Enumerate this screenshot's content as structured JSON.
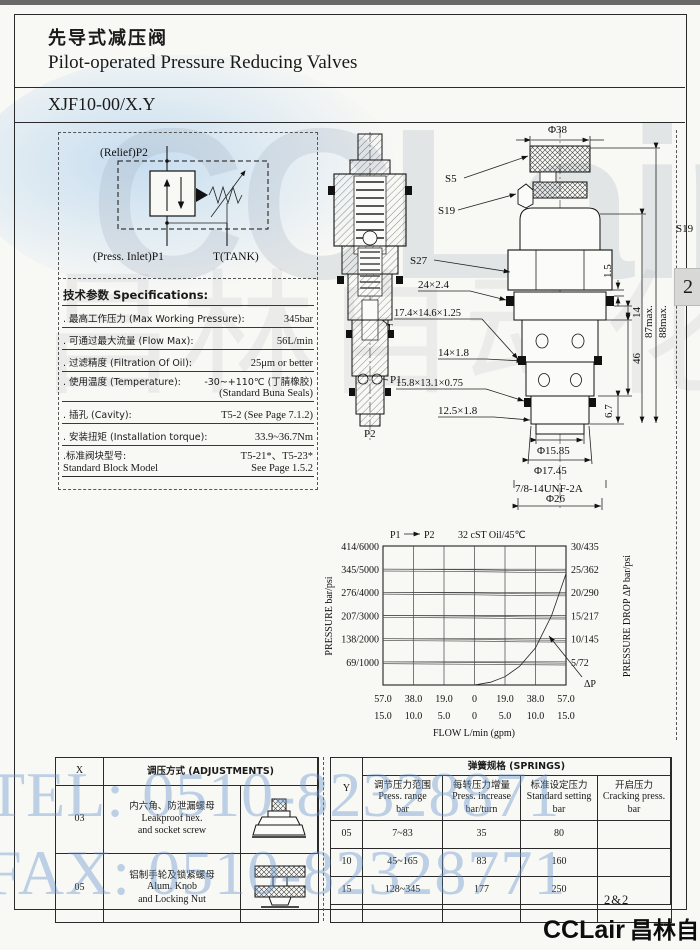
{
  "header": {
    "title_cn": "先导式减压阀",
    "title_en": "Pilot-operated Pressure Reducing Valves",
    "model": "XJF10-00/X.Y"
  },
  "side_tab": "2",
  "schematic": {
    "port_top": "(Relief)P2",
    "port_bottom_left": "(Press. Inlet)P1",
    "port_bottom_right": "T(TANK)"
  },
  "specs": {
    "title": "技术参数 Specifications:",
    "rows": [
      {
        "label": ". 最高工作压力 (Max Working Pressure):",
        "value": "345bar"
      },
      {
        "label": ". 可通过最大流量 (Flow Max):",
        "value": "56L/min"
      },
      {
        "label": ". 过滤精度 (Filtration Of Oil):",
        "value": "25μm or better"
      },
      {
        "label": ". 使用温度 (Temperature):",
        "value": "-30~+110℃ (丁腈橡胶)",
        "value2": "(Standard Buna Seals)"
      },
      {
        "label": ". 插孔 (Cavity):",
        "value": "T5-2 (See Page 7.1.2)"
      },
      {
        "label": ". 安装扭矩 (Installation torque):",
        "value": "33.9~36.7Nm"
      },
      {
        "label": ".标准阀块型号:",
        "label2": "Standard Block Model",
        "value": "T5-21*、T5-23*",
        "value2": "See Page 1.5.2"
      }
    ]
  },
  "section_ports": {
    "t": "T",
    "p1": "P1",
    "p2": "P2"
  },
  "callouts": {
    "s5": "S5",
    "s19": "S19",
    "s27": "S27",
    "seal1": "24×2.4",
    "seal2": "17.4×14.6×1.25",
    "seal3": "14×1.8",
    "seal4": "15.8×13.1×0.75",
    "seal5": "12.5×1.8"
  },
  "outline_dims": {
    "top": "Φ38",
    "right_s19": "S19",
    "d1": "1.5",
    "d2": "14",
    "d3": "46",
    "d4": "6.7",
    "h1": "87max.",
    "h2": "88max.",
    "b1": "Φ15.85",
    "b2": "Φ17.45",
    "b3": "7/8-14UNF-2A",
    "b4": "Φ26"
  },
  "chart": {
    "title_p1": "P1",
    "title_p2": "P2",
    "title_oil": "32 cST Oil/45℃",
    "ylabel_left": "PRESSURE  bar/psi",
    "ylabel_right": "PRESSURE DROP  ΔP  bar/psi",
    "xlabel": "FLOW  L/min (gpm)",
    "annotation": "ΔP",
    "left_ticks": [
      "414/6000",
      "345/5000",
      "276/4000",
      "207/3000",
      "138/2000",
      "69/1000"
    ],
    "right_ticks": [
      "30/435",
      "25/362",
      "20/290",
      "15/217",
      "10/145",
      "5/72"
    ],
    "x_ticks_lmin": [
      "57.0",
      "38.0",
      "19.0",
      "0",
      "19.0",
      "38.0",
      "57.0"
    ],
    "x_ticks_gpm": [
      "15.0",
      "10.0",
      "5.0",
      "0",
      "5.0",
      "10.0",
      "15.0"
    ]
  },
  "chart_data": {
    "type": "line",
    "title": "P1 → P2   32 cST Oil/45℃",
    "xlabel": "FLOW L/min (gpm)",
    "ylabel": "PRESSURE bar/psi (left) / PRESSURE DROP ΔP bar/psi (right)",
    "x_range_lmin": [
      -57,
      57
    ],
    "pressure_axis_bar": [
      0,
      69,
      138,
      207,
      276,
      345,
      414
    ],
    "pressure_axis_psi": [
      0,
      1000,
      2000,
      3000,
      4000,
      5000,
      6000
    ],
    "dp_axis_bar": [
      0,
      5,
      10,
      15,
      20,
      25,
      30
    ],
    "dp_axis_psi": [
      0,
      72,
      145,
      217,
      290,
      362,
      435
    ],
    "legend_position": "none",
    "grid": true,
    "series": [
      {
        "name": "regulated pressure, 345 bar setting",
        "axis": "left",
        "x": [
          -57,
          -28,
          0,
          28,
          57
        ],
        "y": [
          345,
          344,
          343,
          341,
          340
        ]
      },
      {
        "name": "regulated pressure, 276 bar setting",
        "axis": "left",
        "x": [
          -57,
          -28,
          0,
          28,
          57
        ],
        "y": [
          276,
          275,
          274,
          272,
          271
        ]
      },
      {
        "name": "regulated pressure, 207 bar setting",
        "axis": "left",
        "x": [
          -57,
          -28,
          0,
          28,
          57
        ],
        "y": [
          207,
          206,
          205,
          203,
          202
        ]
      },
      {
        "name": "regulated pressure, 138 bar setting",
        "axis": "left",
        "x": [
          -57,
          -28,
          0,
          28,
          57
        ],
        "y": [
          138,
          137,
          136,
          134,
          133
        ]
      },
      {
        "name": "regulated pressure, 69 bar setting",
        "axis": "left",
        "x": [
          -57,
          -28,
          0,
          28,
          57
        ],
        "y": [
          69,
          68,
          67,
          66,
          65
        ]
      }
    ],
    "dp_curve": {
      "name": "ΔP",
      "axis": "right",
      "x": [
        0,
        10,
        19,
        28,
        38,
        48,
        57
      ],
      "y": [
        0,
        0.6,
        1.8,
        4,
        8,
        15,
        24
      ]
    }
  },
  "adjustments": {
    "x_header": "X",
    "title": "调压方式 (ADJUSTMENTS)",
    "rows": [
      {
        "code": "03",
        "cn": "内六角、防泄漏螺母",
        "en1": "Leakproof hex.",
        "en2": "and socket screw",
        "icon": "hex-socket-screw-icon"
      },
      {
        "code": "05",
        "cn": "铝制手轮及锁紧螺母",
        "en1": "Alum. Knob",
        "en2": "and Locking Nut",
        "icon": "alum-knob-icon"
      }
    ]
  },
  "springs": {
    "title": "弹簧规格 (SPRINGS)",
    "y_header": "Y",
    "columns": [
      {
        "cn": "调节压力范围",
        "en": "Press. range",
        "unit": "bar"
      },
      {
        "cn": "每转压力增量",
        "en": "Press. increase",
        "unit": "bar/turn"
      },
      {
        "cn": "标准设定压力",
        "en": "Standard setting",
        "unit": "bar"
      },
      {
        "cn": "开启压力",
        "en": "Cracking press.",
        "unit": "bar"
      }
    ],
    "rows": [
      {
        "y": "05",
        "range": "7~83",
        "increase": "35",
        "setting": "80",
        "cracking": ""
      },
      {
        "y": "10",
        "range": "45~165",
        "increase": "83",
        "setting": "160",
        "cracking": ""
      },
      {
        "y": "15",
        "range": "128~345",
        "increase": "177",
        "setting": "250",
        "cracking": ""
      }
    ]
  },
  "watermarks": {
    "brand": "CCLair",
    "brand_cn": "昌林自动化",
    "tel": "TEL: 0510-82328871",
    "fax": "FAX: 0510-82328771"
  },
  "footer": {
    "page": "2&2",
    "brand_en": "CCLair",
    "brand_cn": "昌林自动化"
  }
}
